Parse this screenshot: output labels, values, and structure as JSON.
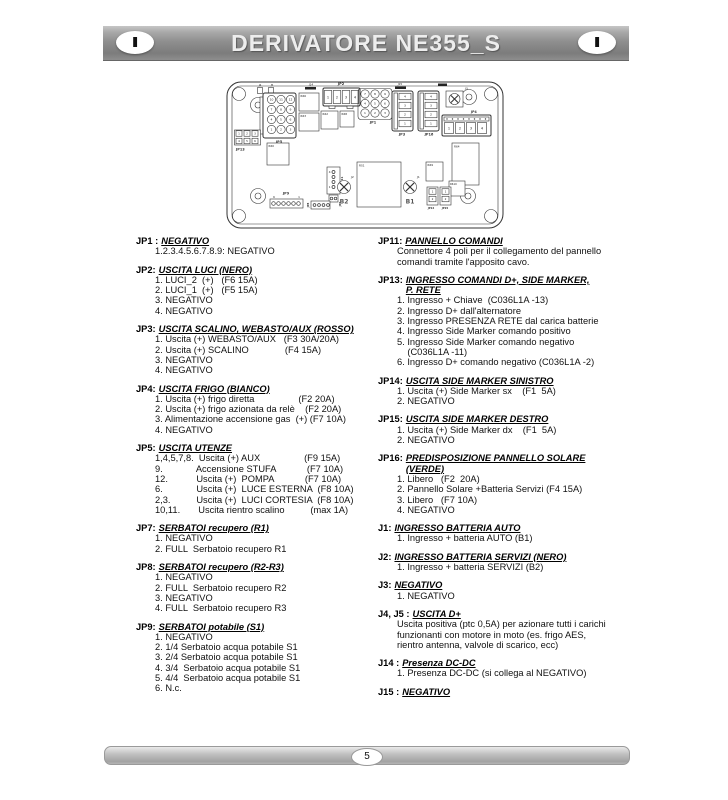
{
  "header": {
    "title": "DERIVATORE NE355_S",
    "badge_left": "I",
    "badge_right": "I"
  },
  "footer": {
    "page_number": "5"
  },
  "pcb": {
    "jp5": {
      "label": "JP5",
      "pins": [
        "10",
        "11",
        "12",
        "7",
        "8",
        "9",
        "4",
        "5",
        "6",
        "1",
        "2",
        "3"
      ]
    },
    "jp1": {
      "label": "JP1",
      "pins": [
        "7",
        "8",
        "9",
        "4",
        "5",
        "6",
        "1",
        "2",
        "3"
      ]
    },
    "jp13": {
      "label": "JP13",
      "pins": [
        "1",
        "2",
        "3",
        "4",
        "5",
        "6"
      ]
    },
    "jp2": {
      "label": "JP2",
      "pins": [
        "1",
        "2",
        "3",
        "4"
      ]
    },
    "jp3": {
      "label": "JP3",
      "pins": [
        "4",
        "3",
        "2",
        "1"
      ]
    },
    "jp16": {
      "label": "JP16",
      "pins": [
        "4",
        "3",
        "2",
        "1"
      ]
    },
    "jp4": {
      "label": "JP4",
      "pins": [
        "1",
        "2",
        "3",
        "4"
      ]
    },
    "jp9": {
      "label": "JP9",
      "pin_left": "6",
      "pin_right": "1"
    },
    "jp11": {
      "label": "JP11",
      "pin_top": "4",
      "pin_bottom": "1"
    },
    "jp7": {
      "label": "JP7"
    },
    "jp8": {
      "label": "JP8"
    },
    "jp14": {
      "label": "JP14",
      "pins": [
        "1",
        "2"
      ]
    },
    "jp15": {
      "label": "JP15",
      "pins": [
        "1",
        "2"
      ]
    },
    "j1": {
      "label": "J1"
    },
    "j2": {
      "label": "J2"
    },
    "j3": {
      "label": "J3"
    },
    "j4": {
      "label": "J4"
    },
    "j5": {
      "label": "J5"
    },
    "j14": {
      "label": "J14"
    },
    "j15": {
      "label": "J15"
    },
    "b1": "B1",
    "b2": "B2",
    "relays": {
      "r66": "R66",
      "r63": "R63",
      "r62": "R62",
      "r68": "R68",
      "r60": "R60",
      "r64": "R64",
      "rs1": "RS1",
      "r69": "R69",
      "r610": "R610"
    }
  },
  "sections_left": [
    {
      "prefix": "JP1 :",
      "title_lines": [
        "NEGATIVO"
      ],
      "lines": [
        "1.2.3.4.5.6.7.8.9: NEGATIVO"
      ]
    },
    {
      "prefix": "JP2:",
      "title_lines": [
        "USCITA LUCI (NERO)"
      ],
      "lines": [
        "1. LUCI_2  (+)   (F6 15A)",
        "2. LUCI_1  (+)   (F5 15A)",
        "3. NEGATIVO",
        "4. NEGATIVO"
      ]
    },
    {
      "prefix": "JP3:",
      "title_lines": [
        "USCITA  SCALINO, WEBASTO/AUX  (ROSSO)"
      ],
      "lines": [
        "1. Uscita (+) WEBASTO/AUX   (F3 30A/20A)",
        "2. Uscita (+) SCALINO              (F4 15A)",
        "3. NEGATIVO",
        "4. NEGATIVO"
      ]
    },
    {
      "prefix": "JP4:",
      "title_lines": [
        "USCITA FRIGO (BIANCO)"
      ],
      "lines": [
        "1. Uscita (+) frigo diretta                 (F2 20A)",
        "2. Uscita (+) frigo azionata da relè    (F2 20A)",
        "3. Alimentazione accensione gas  (+) (F7 10A)",
        "4. NEGATIVO"
      ]
    },
    {
      "prefix": "JP5:",
      "title_lines": [
        "USCITA UTENZE"
      ],
      "lines": [
        "1,4,5,7,8.  Uscita (+) AUX                 (F9 15A)",
        "9.             Accensione STUFA            (F7 10A)",
        "12.           Uscita (+)  POMPA            (F7 10A)",
        "6.             Uscita (+)  LUCE ESTERNA  (F8 10A)",
        "2,3.          Uscita (+)  LUCI CORTESIA  (F8 10A)",
        "10,11.       Uscita rientro scalino          (max 1A)"
      ]
    },
    {
      "prefix": "JP7:",
      "title_lines": [
        "SERBATOI recupero  (R1)"
      ],
      "lines": [
        "1. NEGATIVO",
        "2. FULL  Serbatoio recupero R1"
      ]
    },
    {
      "prefix": "JP8:",
      "title_lines": [
        "SERBATOI recupero  (R2-R3)"
      ],
      "lines": [
        "1. NEGATIVO",
        "2. FULL  Serbatoio recupero R2",
        "3. NEGATIVO",
        "4. FULL  Serbatoio recupero R3"
      ]
    },
    {
      "prefix": "JP9:",
      "title_lines": [
        "SERBATOI potabile (S1)"
      ],
      "lines": [
        "1. NEGATIVO",
        "2. 1/4 Serbatoio acqua potabile S1",
        "3. 2/4 Serbatoio acqua potabile S1",
        "4. 3/4  Serbatoio acqua potabile S1",
        "5. 4/4  Serbatoio acqua potabile S1",
        "6. N.c."
      ]
    }
  ],
  "sections_right": [
    {
      "prefix": "JP11:",
      "title_lines": [
        "PANNELLO COMANDI"
      ],
      "lines": [
        "Connettore 4 poli per il collegamento del pannello",
        "comandi tramite l'apposito cavo."
      ]
    },
    {
      "prefix": "JP13:",
      "title_lines": [
        "INGRESSO COMANDI D+, SIDE MARKER,",
        "P. RETE"
      ],
      "lines": [
        "1. Ingresso + Chiave  (C036L1A -13)",
        "2. Ingresso D+ dall'alternatore",
        "3. Ingresso PRESENZA RETE dal carica batterie",
        "4. Ingresso Side Marker comando positivo",
        "5. Ingresso Side Marker comando negativo",
        "    (C036L1A -11)",
        "6. Ingresso D+ comando negativo (C036L1A -2)"
      ]
    },
    {
      "prefix": "JP14:",
      "title_lines": [
        "USCITA SIDE MARKER SINISTRO"
      ],
      "lines": [
        "1. Uscita (+) Side Marker sx    (F1  5A)",
        "2. NEGATIVO"
      ]
    },
    {
      "prefix": "JP15:",
      "title_lines": [
        "USCITA SIDE MARKER DESTRO"
      ],
      "lines": [
        "1. Uscita (+) Side Marker dx    (F1  5A)",
        "2. NEGATIVO"
      ]
    },
    {
      "prefix": "JP16:",
      "title_lines": [
        "PREDISPOSIZIONE PANNELLO SOLARE",
        "(VERDE)"
      ],
      "lines": [
        "1. Libero   (F2  20A)",
        "2. Pannello Solare +Batteria Servizi (F4 15A)",
        "3. Libero   (F7 10A)",
        "4. NEGATIVO"
      ]
    },
    {
      "prefix": "J1:",
      "title_lines": [
        "INGRESSO BATTERIA  AUTO"
      ],
      "lines": [
        "1. Ingresso + batteria AUTO (B1)"
      ]
    },
    {
      "prefix": "J2:",
      "title_lines": [
        "INGRESSO BATTERIA  SERVIZI (NERO)"
      ],
      "lines": [
        "1. Ingresso + batteria SERVIZI (B2)"
      ]
    },
    {
      "prefix": "J3:",
      "title_lines": [
        "NEGATIVO"
      ],
      "lines": [
        "1. NEGATIVO"
      ]
    },
    {
      "prefix": "J4, J5 :",
      "title_lines": [
        "USCITA D+"
      ],
      "lines": [
        "Uscita positiva (ptc 0,5A) per azionare tutti i carichi",
        "funzionanti con motore in moto (es. frigo AES,",
        "rientro antenna, valvole di scarico, ecc)"
      ]
    },
    {
      "prefix": "J14 :",
      "title_lines": [
        "Presenza DC-DC"
      ],
      "lines": [
        "1. Presenza DC-DC (si collega al NEGATIVO)"
      ]
    },
    {
      "prefix": "J15 :",
      "title_lines": [
        "NEGATIVO"
      ],
      "lines": []
    }
  ]
}
